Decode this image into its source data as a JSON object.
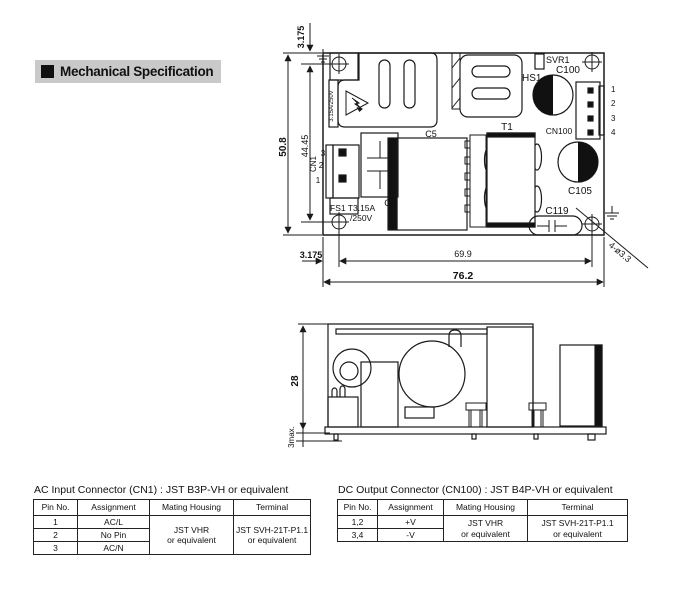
{
  "header": {
    "title": "Mechanical Specification"
  },
  "top_view": {
    "dims": {
      "total_width": "76.2",
      "hole_span_width": "69.9",
      "hole_offset_bottom": "3.175",
      "total_height": "50.8",
      "hole_span_height": "44.45",
      "hole_offset_top": "3.175",
      "hole_note": "4-ø3.3"
    },
    "components": {
      "fuse_strip": "3.15A/250V",
      "cn1": "CN1",
      "cn1_pins": [
        "3",
        "2",
        "1"
      ],
      "fs1_line1": "FS1 T3.15A",
      "fs1_line2": "/250V",
      "c1": "C1",
      "c5": "C5",
      "t1": "T1",
      "hs1": "HS1",
      "svr1": "SVR1",
      "c100": "C100",
      "cn100": "CN100",
      "cn100_pins": [
        "1",
        "2",
        "3",
        "4"
      ],
      "c105": "C105",
      "c119": "C119"
    }
  },
  "side_view": {
    "dims": {
      "height": "28",
      "pin_length": "3max."
    }
  },
  "ac_table": {
    "title": "AC Input Connector (CN1) : JST B3P-VH or equivalent",
    "headers": [
      "Pin No.",
      "Assignment",
      "Mating Housing",
      "Terminal"
    ],
    "rows": [
      {
        "pin": "1",
        "assignment": "AC/L"
      },
      {
        "pin": "2",
        "assignment": "No Pin"
      },
      {
        "pin": "3",
        "assignment": "AC/N"
      }
    ],
    "mating_housing": [
      "JST VHR",
      "or equivalent"
    ],
    "terminal": [
      "JST SVH-21T-P1.1",
      "or equivalent"
    ]
  },
  "dc_table": {
    "title": "DC Output Connector (CN100) : JST B4P-VH or equivalent",
    "headers": [
      "Pin No.",
      "Assignment",
      "Mating Housing",
      "Terminal"
    ],
    "rows": [
      {
        "pin": "1,2",
        "assignment": "+V"
      },
      {
        "pin": "3,4",
        "assignment": "-V"
      }
    ],
    "mating_housing": [
      "JST VHR",
      "or equivalent"
    ],
    "terminal": [
      "JST SVH-21T-P1.1",
      "or equivalent"
    ]
  },
  "colors": {
    "line": "#1a1a1a",
    "title_bg": "#c9c9c9",
    "fill": "#111111"
  }
}
